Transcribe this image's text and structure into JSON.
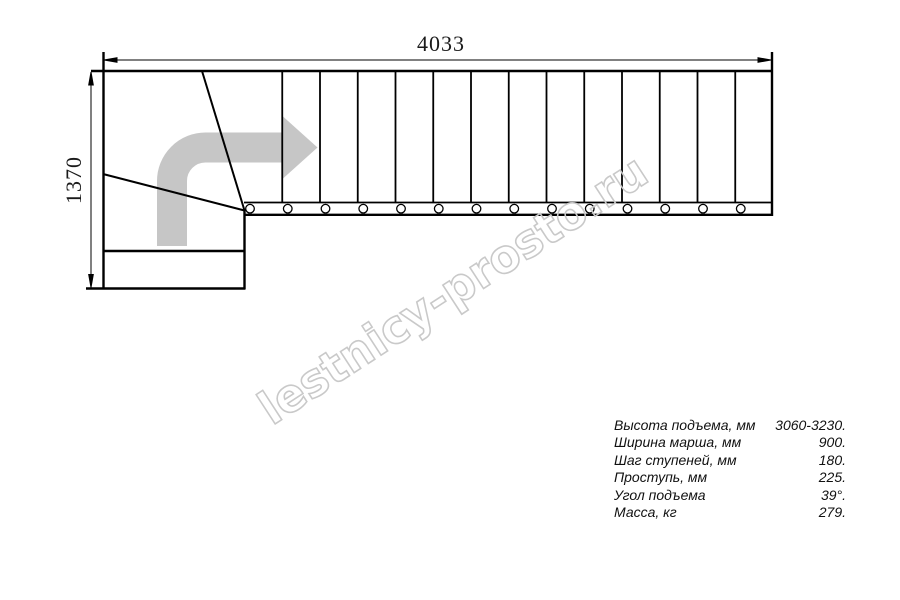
{
  "page": {
    "background": "#ffffff"
  },
  "dimensions": {
    "top_length": "4033",
    "left_width": "1370"
  },
  "specs": {
    "rows": [
      {
        "label": "Высота подъема, мм",
        "value": "3060-3230."
      },
      {
        "label": "Ширина марша, мм",
        "value": "900."
      },
      {
        "label": "Шаг ступеней, мм",
        "value": "180."
      },
      {
        "label": "Проступь, мм",
        "value": "225."
      },
      {
        "label": "Угол подъема",
        "value": "39°."
      },
      {
        "label": "Масса, кг",
        "value": "279."
      }
    ]
  },
  "watermark": {
    "text": "lestnicy-prosto.ru",
    "color": "#c9c9c9"
  },
  "diagram": {
    "straight_tread_count": 14,
    "baluster_count": 14,
    "winder_tread_count": 3,
    "arrow_color": "#c6c6c6",
    "line_color": "#000000"
  }
}
